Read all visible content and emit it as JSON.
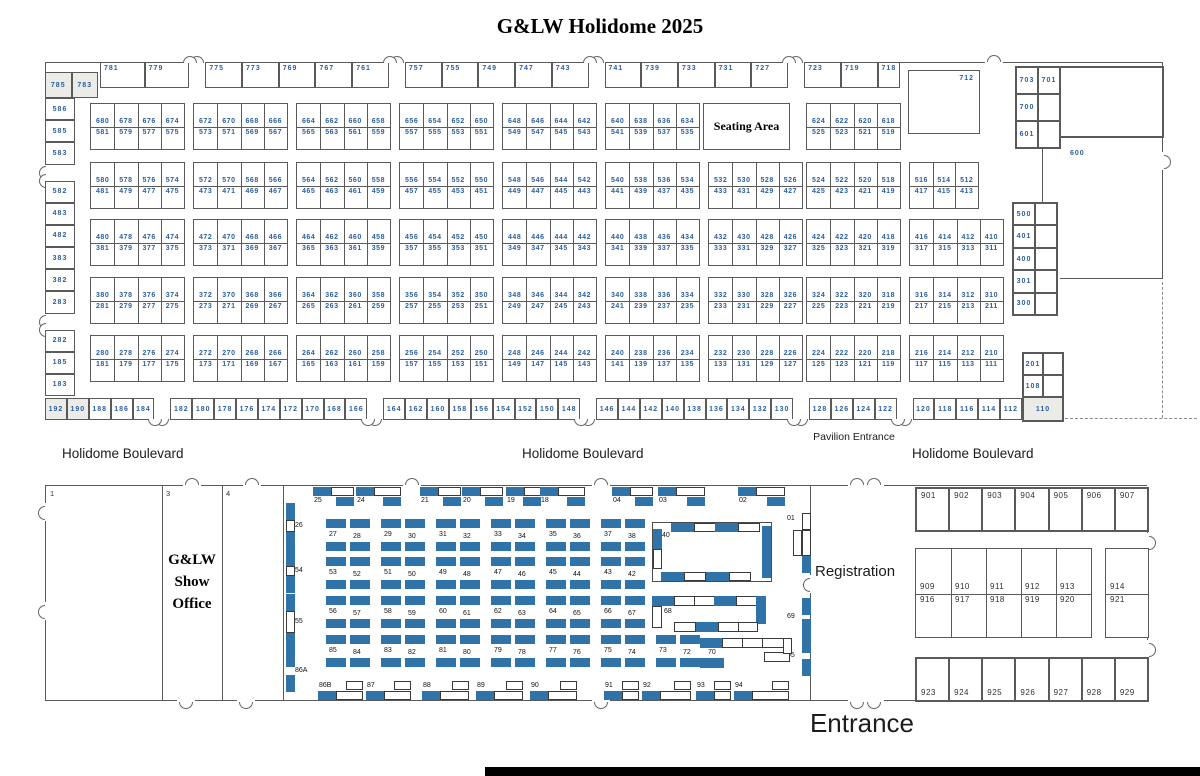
{
  "title": "G&LW Holidome 2025",
  "colors": {
    "number_blue": "#2b5f9e",
    "table_blue": "#2f73a9",
    "wall": "#5a5a5a",
    "gray_fill": "#ebebe8"
  },
  "boulevard": [
    "Holidome Boulevard",
    "Holidome Boulevard",
    "Holidome Boulevard"
  ],
  "upper_hall": {
    "seating_area": "Seating Area",
    "pavilion_entrance": "Pavilion Entrance",
    "booth_712": "712",
    "label_600": "600",
    "booth_110": "110",
    "corner_cells": [
      "785",
      "783"
    ],
    "top_strip": [
      "781",
      "779",
      "|",
      "775",
      "773",
      "769",
      "767",
      "761",
      "|",
      "757",
      "755",
      "749",
      "747",
      "743",
      "|",
      "741",
      "739",
      "733",
      "731",
      "727",
      "|",
      "723",
      "719",
      "718"
    ],
    "left_wall": [
      "586",
      "585",
      "583",
      "|",
      "582",
      "483",
      "482",
      "383",
      "382",
      "283",
      "|",
      "282",
      "185",
      "183"
    ],
    "ne_cells": [
      [
        "703",
        "701"
      ],
      [
        "700",
        ""
      ],
      [
        "601",
        ""
      ]
    ],
    "right_wall": [
      [
        "500",
        ""
      ],
      [
        "401",
        ""
      ],
      [
        "400",
        ""
      ],
      [
        "301",
        ""
      ],
      [
        "300",
        ""
      ]
    ],
    "right_lower": [
      [
        "201",
        ""
      ],
      [
        "108",
        ""
      ]
    ],
    "bottom_strip": [
      "192",
      "190",
      "188",
      "186",
      "184",
      "|",
      "182",
      "180",
      "178",
      "176",
      "174",
      "172",
      "170",
      "168",
      "166",
      "|",
      "164",
      "162",
      "160",
      "158",
      "156",
      "154",
      "152",
      "150",
      "148",
      "|",
      "146",
      "144",
      "142",
      "140",
      "138",
      "136",
      "134",
      "132",
      "130",
      "|",
      "128",
      "126",
      "124",
      "122",
      "|",
      "120",
      "118",
      "116",
      "114",
      "112"
    ],
    "gray_cells": [
      "785",
      "783",
      "192",
      "190",
      "110"
    ],
    "block_rows": [
      {
        "row": 0,
        "blocks": [
          {
            "c": 0,
            "top": [
              "680",
              "678",
              "676",
              "674"
            ],
            "bot": [
              "581",
              "579",
              "577",
              "575"
            ]
          },
          {
            "c": 1,
            "top": [
              "672",
              "670",
              "668",
              "666"
            ],
            "bot": [
              "573",
              "571",
              "569",
              "567"
            ]
          },
          {
            "c": 2,
            "top": [
              "664",
              "662",
              "660",
              "658"
            ],
            "bot": [
              "565",
              "563",
              "561",
              "559"
            ]
          },
          {
            "c": 3,
            "top": [
              "656",
              "654",
              "652",
              "650"
            ],
            "bot": [
              "557",
              "555",
              "553",
              "551"
            ]
          },
          {
            "c": 4,
            "top": [
              "648",
              "646",
              "644",
              "642"
            ],
            "bot": [
              "549",
              "547",
              "545",
              "543"
            ]
          },
          {
            "c": 5,
            "top": [
              "640",
              "638",
              "636",
              "634"
            ],
            "bot": [
              "541",
              "539",
              "537",
              "535"
            ]
          },
          {
            "c": 7,
            "top": [
              "624",
              "622",
              "620",
              "618"
            ],
            "bot": [
              "525",
              "523",
              "521",
              "519"
            ]
          }
        ]
      },
      {
        "row": 1,
        "blocks": [
          {
            "c": 0,
            "top": [
              "580",
              "578",
              "576",
              "574"
            ],
            "bot": [
              "481",
              "479",
              "477",
              "475"
            ]
          },
          {
            "c": 1,
            "top": [
              "572",
              "570",
              "568",
              "566"
            ],
            "bot": [
              "473",
              "471",
              "469",
              "467"
            ]
          },
          {
            "c": 2,
            "top": [
              "564",
              "562",
              "560",
              "558"
            ],
            "bot": [
              "465",
              "463",
              "461",
              "459"
            ]
          },
          {
            "c": 3,
            "top": [
              "556",
              "554",
              "552",
              "550"
            ],
            "bot": [
              "457",
              "455",
              "453",
              "451"
            ]
          },
          {
            "c": 4,
            "top": [
              "548",
              "546",
              "544",
              "542"
            ],
            "bot": [
              "449",
              "447",
              "445",
              "443"
            ]
          },
          {
            "c": 5,
            "top": [
              "540",
              "538",
              "536",
              "534"
            ],
            "bot": [
              "441",
              "439",
              "437",
              "435"
            ]
          },
          {
            "c": 6,
            "top": [
              "532",
              "530",
              "528",
              "526"
            ],
            "bot": [
              "433",
              "431",
              "429",
              "427"
            ]
          },
          {
            "c": 7,
            "top": [
              "524",
              "522",
              "520",
              "518"
            ],
            "bot": [
              "425",
              "423",
              "421",
              "419"
            ]
          },
          {
            "c": 8,
            "narrow": true,
            "top": [
              "516",
              "514",
              "512"
            ],
            "bot": [
              "417",
              "415",
              "413"
            ]
          }
        ]
      },
      {
        "row": 2,
        "blocks": [
          {
            "c": 0,
            "top": [
              "480",
              "478",
              "476",
              "474"
            ],
            "bot": [
              "381",
              "379",
              "377",
              "375"
            ]
          },
          {
            "c": 1,
            "top": [
              "472",
              "470",
              "468",
              "466"
            ],
            "bot": [
              "373",
              "371",
              "369",
              "367"
            ]
          },
          {
            "c": 2,
            "top": [
              "464",
              "462",
              "460",
              "458"
            ],
            "bot": [
              "365",
              "363",
              "361",
              "359"
            ]
          },
          {
            "c": 3,
            "top": [
              "456",
              "454",
              "452",
              "450"
            ],
            "bot": [
              "357",
              "355",
              "353",
              "351"
            ]
          },
          {
            "c": 4,
            "top": [
              "448",
              "446",
              "444",
              "442"
            ],
            "bot": [
              "349",
              "347",
              "345",
              "343"
            ]
          },
          {
            "c": 5,
            "top": [
              "440",
              "438",
              "436",
              "434"
            ],
            "bot": [
              "341",
              "339",
              "337",
              "335"
            ]
          },
          {
            "c": 6,
            "top": [
              "432",
              "430",
              "428",
              "426"
            ],
            "bot": [
              "333",
              "331",
              "329",
              "327"
            ]
          },
          {
            "c": 7,
            "top": [
              "424",
              "422",
              "420",
              "418"
            ],
            "bot": [
              "325",
              "323",
              "321",
              "319"
            ]
          },
          {
            "c": 8,
            "top": [
              "416",
              "414",
              "412",
              "410"
            ],
            "bot": [
              "317",
              "315",
              "313",
              "311"
            ]
          }
        ]
      },
      {
        "row": 3,
        "blocks": [
          {
            "c": 0,
            "top": [
              "380",
              "378",
              "376",
              "374"
            ],
            "bot": [
              "281",
              "279",
              "277",
              "275"
            ]
          },
          {
            "c": 1,
            "top": [
              "372",
              "370",
              "368",
              "366"
            ],
            "bot": [
              "273",
              "271",
              "269",
              "267"
            ]
          },
          {
            "c": 2,
            "top": [
              "364",
              "362",
              "360",
              "358"
            ],
            "bot": [
              "265",
              "263",
              "261",
              "259"
            ]
          },
          {
            "c": 3,
            "top": [
              "356",
              "354",
              "352",
              "350"
            ],
            "bot": [
              "257",
              "255",
              "253",
              "251"
            ]
          },
          {
            "c": 4,
            "top": [
              "348",
              "346",
              "344",
              "342"
            ],
            "bot": [
              "249",
              "247",
              "245",
              "243"
            ]
          },
          {
            "c": 5,
            "top": [
              "340",
              "338",
              "336",
              "334"
            ],
            "bot": [
              "241",
              "239",
              "237",
              "235"
            ]
          },
          {
            "c": 6,
            "top": [
              "332",
              "330",
              "328",
              "326"
            ],
            "bot": [
              "233",
              "231",
              "229",
              "227"
            ]
          },
          {
            "c": 7,
            "top": [
              "324",
              "322",
              "320",
              "318"
            ],
            "bot": [
              "225",
              "223",
              "221",
              "219"
            ]
          },
          {
            "c": 8,
            "top": [
              "316",
              "314",
              "312",
              "310"
            ],
            "bot": [
              "217",
              "215",
              "213",
              "211"
            ]
          }
        ]
      },
      {
        "row": 4,
        "blocks": [
          {
            "c": 0,
            "top": [
              "280",
              "278",
              "276",
              "274"
            ],
            "bot": [
              "181",
              "179",
              "177",
              "175"
            ]
          },
          {
            "c": 1,
            "top": [
              "272",
              "270",
              "268",
              "266"
            ],
            "bot": [
              "173",
              "171",
              "169",
              "167"
            ]
          },
          {
            "c": 2,
            "top": [
              "264",
              "262",
              "260",
              "258"
            ],
            "bot": [
              "165",
              "163",
              "161",
              "159"
            ]
          },
          {
            "c": 3,
            "top": [
              "256",
              "254",
              "252",
              "250"
            ],
            "bot": [
              "157",
              "155",
              "153",
              "151"
            ]
          },
          {
            "c": 4,
            "top": [
              "248",
              "246",
              "244",
              "242"
            ],
            "bot": [
              "149",
              "147",
              "145",
              "143"
            ]
          },
          {
            "c": 5,
            "top": [
              "240",
              "238",
              "236",
              "234"
            ],
            "bot": [
              "141",
              "139",
              "137",
              "135"
            ]
          },
          {
            "c": 6,
            "top": [
              "232",
              "230",
              "228",
              "226"
            ],
            "bot": [
              "133",
              "131",
              "129",
              "127"
            ]
          },
          {
            "c": 7,
            "top": [
              "224",
              "222",
              "220",
              "218"
            ],
            "bot": [
              "125",
              "123",
              "121",
              "119"
            ]
          },
          {
            "c": 8,
            "top": [
              "216",
              "214",
              "212",
              "210"
            ],
            "bot": [
              "117",
              "115",
              "113",
              "111"
            ]
          }
        ]
      }
    ]
  },
  "lower_hall": {
    "rooms": {
      "r1": "1",
      "r3": "3",
      "r4": "4"
    },
    "show_office": [
      "G&LW",
      "Show",
      "Office"
    ],
    "registration": "Registration",
    "entrance": "Entrance",
    "top_clusters": [
      "25",
      "24",
      "21",
      "20",
      "19",
      "18",
      "04",
      "03",
      "02"
    ],
    "pair_rows": [
      {
        "pairs": [
          [
            "27",
            "28"
          ],
          [
            "29",
            "30"
          ],
          [
            "31",
            "32"
          ],
          [
            "33",
            "34"
          ],
          [
            "35",
            "36"
          ],
          [
            "37",
            "38"
          ]
        ]
      },
      {
        "pairs": [
          [
            "53",
            "52"
          ],
          [
            "51",
            "50"
          ],
          [
            "49",
            "48"
          ],
          [
            "47",
            "46"
          ],
          [
            "45",
            "44"
          ],
          [
            "43",
            "42"
          ]
        ]
      },
      {
        "pairs": [
          [
            "56",
            "57"
          ],
          [
            "58",
            "59"
          ],
          [
            "60",
            "61"
          ],
          [
            "62",
            "63"
          ],
          [
            "64",
            "65"
          ],
          [
            "66",
            "67"
          ]
        ]
      },
      {
        "pairs": [
          [
            "85",
            "84"
          ],
          [
            "83",
            "82"
          ],
          [
            "81",
            "80"
          ],
          [
            "79",
            "78"
          ],
          [
            "77",
            "76"
          ],
          [
            "75",
            "74"
          ],
          [
            "73",
            "72"
          ]
        ]
      }
    ],
    "ring_booth": "40",
    "long_booth_68": "68",
    "long_booth_70": "70",
    "left_clusters": [
      "26",
      "54",
      "55",
      "86A"
    ],
    "right_clusters": [
      "01",
      "69",
      "95"
    ],
    "bottom_clusters": [
      "86B",
      "87",
      "88",
      "89",
      "90",
      "91",
      "92",
      "93",
      "94"
    ],
    "nine_hundreds": {
      "top_row": [
        "901",
        "902",
        "903",
        "904",
        "905",
        "906",
        "907"
      ],
      "mid_top": [
        "909",
        "910",
        "911",
        "912",
        "913"
      ],
      "mid_bottom": [
        "916",
        "917",
        "918",
        "919",
        "920"
      ],
      "side_top": "914",
      "side_bottom": "921",
      "bottom_row": [
        "923",
        "924",
        "925",
        "926",
        "927",
        "928",
        "929"
      ]
    }
  }
}
